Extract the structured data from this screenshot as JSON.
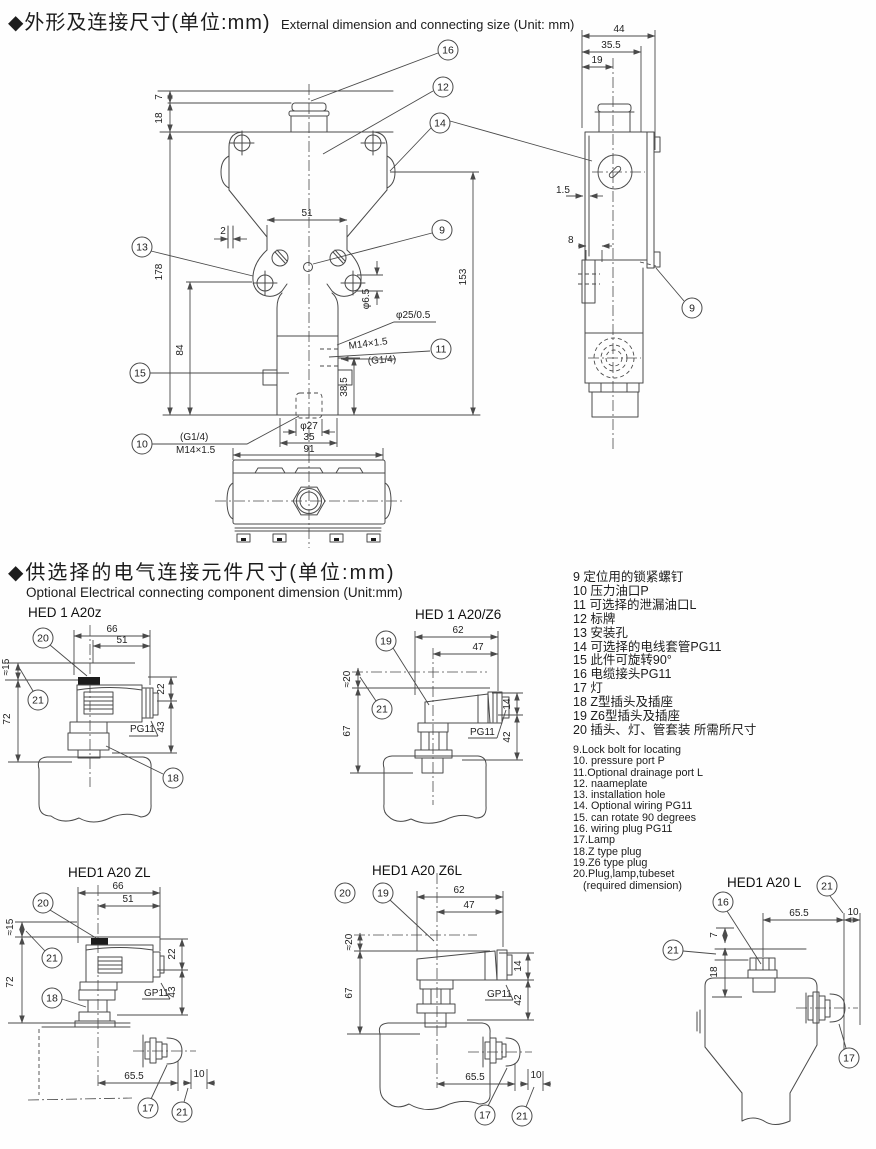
{
  "s1": {
    "title_zh": "◆外形及连接尺寸(单位:mm)",
    "title_en": "External dimension and connecting size (Unit: mm)",
    "fv": {
      "d7": "7",
      "d18": "18",
      "d178": "178",
      "d84": "84",
      "d51": "51",
      "d2": "2",
      "d153": "153",
      "dia65": "φ6.5",
      "dia25": "φ25/0.5",
      "m14": "M14×1.5",
      "g14": "(G1/4)",
      "d385": "38.5",
      "dia27": "φ27",
      "d35": "35",
      "d91": "91",
      "p_g14": "(G1/4)",
      "p_m14": "M14×1.5"
    },
    "sv": {
      "d44": "44",
      "d355": "35.5",
      "d19": "19",
      "d15": "1.5",
      "d8": "8"
    },
    "c": {
      "c9": "9",
      "c10": "10",
      "c11": "11",
      "c12": "12",
      "c13": "13",
      "c14": "14",
      "c15": "15",
      "c16": "16"
    }
  },
  "s2": {
    "title_zh": "◆供选择的电气连接元件尺寸(单位:mm)",
    "title_en": "Optional Electrical connecting component dimension (Unit:mm)",
    "z": {
      "label": "HED 1 A20z",
      "d66": "66",
      "d51": "51",
      "d15": "≈15",
      "d72": "72",
      "d22": "22",
      "d43": "43",
      "g": "PG11"
    },
    "z6": {
      "label": "HED 1 A20/Z6",
      "d62": "62",
      "d47": "47",
      "d20": "≈20",
      "d67": "67",
      "d14": "14",
      "d42": "42",
      "g": "PG11"
    },
    "zl": {
      "label": "HED1 A20 ZL",
      "d66": "66",
      "d51": "51",
      "d15": "≈15",
      "d72": "72",
      "d22": "22",
      "d43": "43",
      "g": "GP11",
      "d655": "65.5",
      "d10": "10"
    },
    "z6l": {
      "label": "HED1 A20 Z6L",
      "d62": "62",
      "d47": "47",
      "d20": "≈20",
      "d67": "67",
      "d14": "14",
      "d42": "42",
      "g": "GP11",
      "d655": "65.5",
      "d10": "10"
    },
    "l": {
      "label": "HED1 A20 L",
      "d655": "65.5",
      "d10": "10",
      "d7": "7",
      "d18": "18"
    },
    "c": {
      "c16": "16",
      "c17": "17",
      "c18": "18",
      "c19": "19",
      "c20": "20",
      "c21": "21"
    }
  },
  "parts_zh": {
    "items": [
      "9 定位用的锁紧螺钉",
      "10 压力油口P",
      "11 可选择的泄漏油口L",
      "12 标牌",
      "13 安装孔",
      "14 可选择的电线套管PG11",
      "15 此件可旋转90°",
      "16 电缆接头PG11",
      "17 灯",
      "18 Z型插头及插座",
      "19 Z6型插头及插座",
      "20 插头、灯、管套装 所需所尺寸"
    ]
  },
  "parts_en": {
    "items": [
      "9.Lock bolt for locating",
      "10. pressure port P",
      "11.Optional drainage port L",
      "12. naameplate",
      "13. installation hole",
      "14. Optional wiring PG11",
      "15. can rotate 90 degrees",
      "16. wiring plug PG11",
      "17.Lamp",
      "18.Z type plug",
      "19.Z6 type plug",
      "20.Plug,lamp,tubeset",
      "(required dimension)"
    ]
  }
}
